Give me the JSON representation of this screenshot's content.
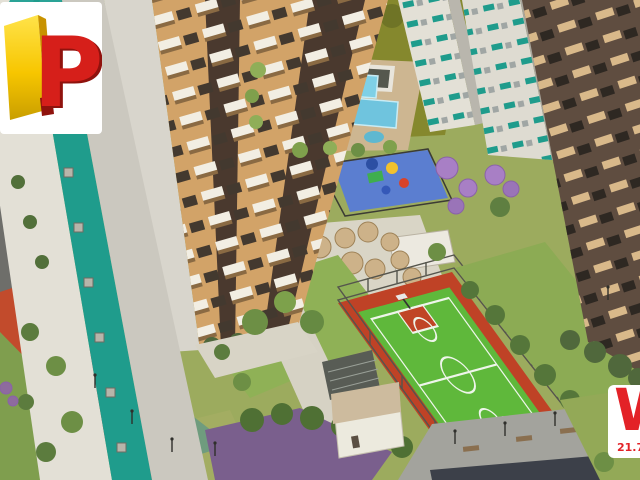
{
  "image": {
    "description": "Aerial 3D architectural rendering of a residential condominium: apartment towers, leisure deck with pools, playground, seating umbrellas, sports court, jogging track and gardens"
  },
  "logo_badge": {
    "letter": "P",
    "letter_color": "#d61f1a",
    "letter_shadow": "#8f120d",
    "block_color": "#f7c600",
    "bg": "#ffffff"
  },
  "watermark_badge": {
    "letter": "W",
    "caption": "21.7",
    "color": "#e32227",
    "bg": "#ffffff"
  },
  "colors": {
    "base": "#9cab5e",
    "olive": "#85882d",
    "lawn": "#8fb156",
    "lawn_pale": "#a8b163",
    "court_green": "#5fb83b",
    "court_red": "#bf4226",
    "track_red": "#c24b2c",
    "playground_blue": "#5b7ed0",
    "pool": "#7fd0e6",
    "deck": "#cdb691",
    "path": "#d9d5c6",
    "plaza": "#a3a39d",
    "road": "#6e6e6a",
    "tower_white": "#e3e0d6",
    "tower_gray": "#cbc8bf",
    "teal": "#1f9c8c",
    "beige": "#d2a368",
    "brown": "#4a392e",
    "dark_tower": "#5f4d40",
    "purple_ground": "#7a5f8d",
    "purple_tree": "#a87fc5"
  }
}
